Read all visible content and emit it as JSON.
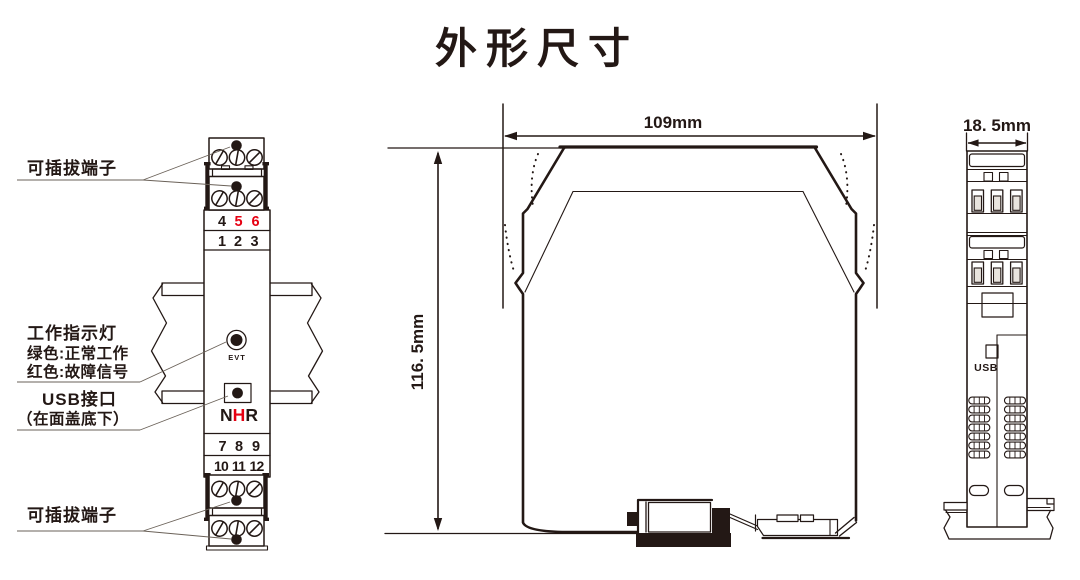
{
  "title": "外形尺寸",
  "colors": {
    "line": "#231815",
    "accent_red": "#e60012"
  },
  "front_view": {
    "labels": {
      "plug_top": "可插拔端子",
      "indicator_1": "工作指示灯",
      "indicator_2": "绿色:正常工作",
      "indicator_3": "红色:故障信号",
      "usb_1": "USB接口",
      "usb_2": "（在面盖底下）",
      "plug_bottom": "可插拔端子"
    },
    "led_text": "EVT",
    "logo": {
      "l1": "N",
      "l2": "H",
      "l3": "R"
    },
    "terminal_numbers": {
      "row_456": [
        "4",
        "5",
        "6"
      ],
      "row_123": [
        "1",
        "2",
        "3"
      ],
      "row_789": [
        "7",
        "8",
        "9"
      ],
      "row_101112": [
        "10",
        "11",
        "12"
      ]
    }
  },
  "side_view": {
    "width_label": "109mm",
    "height_label": "116. 5mm"
  },
  "end_view": {
    "width_label": "18. 5mm",
    "usb_text": "USB"
  }
}
